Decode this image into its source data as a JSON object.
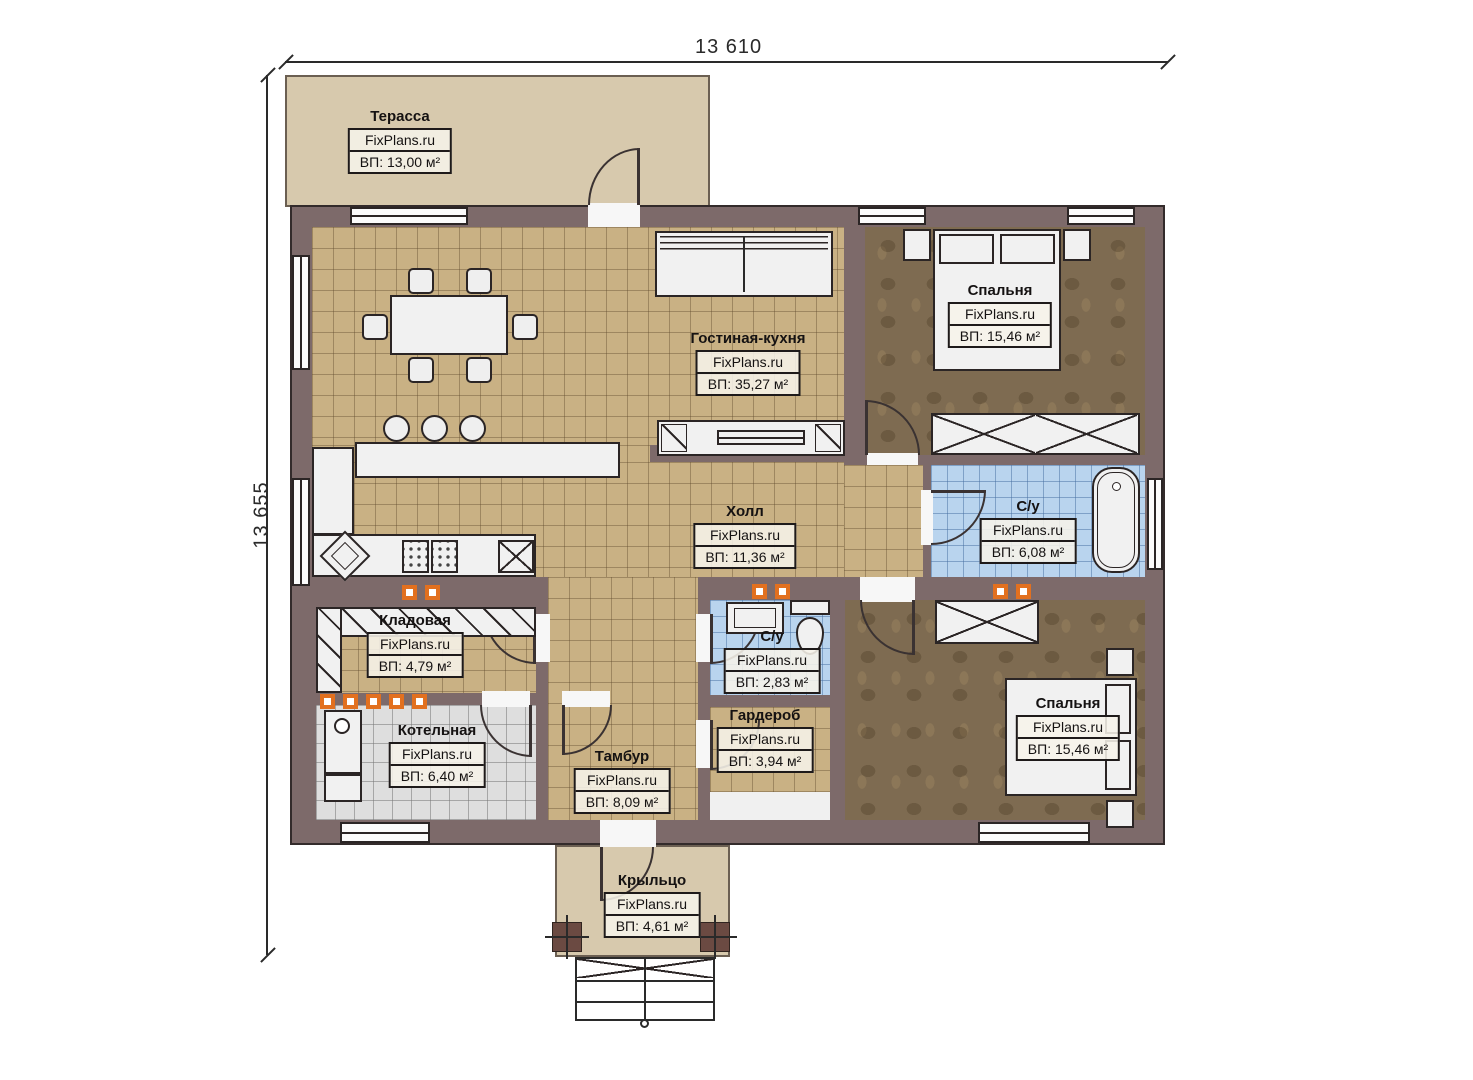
{
  "plan": {
    "brand": "FixPlans.ru",
    "dimensions": {
      "width_label": "13 610",
      "height_label": "13 655"
    },
    "rooms": [
      {
        "name": "Терасса",
        "area": "ВП: 13,00 м²"
      },
      {
        "name": "Гостиная-кухня",
        "area": "ВП: 35,27 м²"
      },
      {
        "name": "Спальня",
        "area": "ВП: 15,46 м²"
      },
      {
        "name": "Холл",
        "area": "ВП: 11,36 м²"
      },
      {
        "name": "С/у",
        "area": "ВП: 6,08 м²"
      },
      {
        "name": "Кладовая",
        "area": "ВП: 4,79 м²"
      },
      {
        "name": "С/у",
        "area": "ВП: 2,83 м²"
      },
      {
        "name": "Гардероб",
        "area": "ВП: 3,94 м²"
      },
      {
        "name": "Котельная",
        "area": "ВП: 6,40 м²"
      },
      {
        "name": "Тамбур",
        "area": "ВП: 8,09 м²"
      },
      {
        "name": "Спальня",
        "area": "ВП: 15,46 м²"
      },
      {
        "name": "Крыльцо",
        "area": "ВП: 4,61 м²"
      }
    ],
    "colors": {
      "wall": "#7d6a6a",
      "floor_tan": "#c9b184",
      "floor_bedroom": "#7e6b51",
      "floor_bath": "#b9d4ee",
      "floor_boiler": "#dedede",
      "outdoor": "#d7c9ad",
      "vent_accent": "#e2701f"
    }
  }
}
